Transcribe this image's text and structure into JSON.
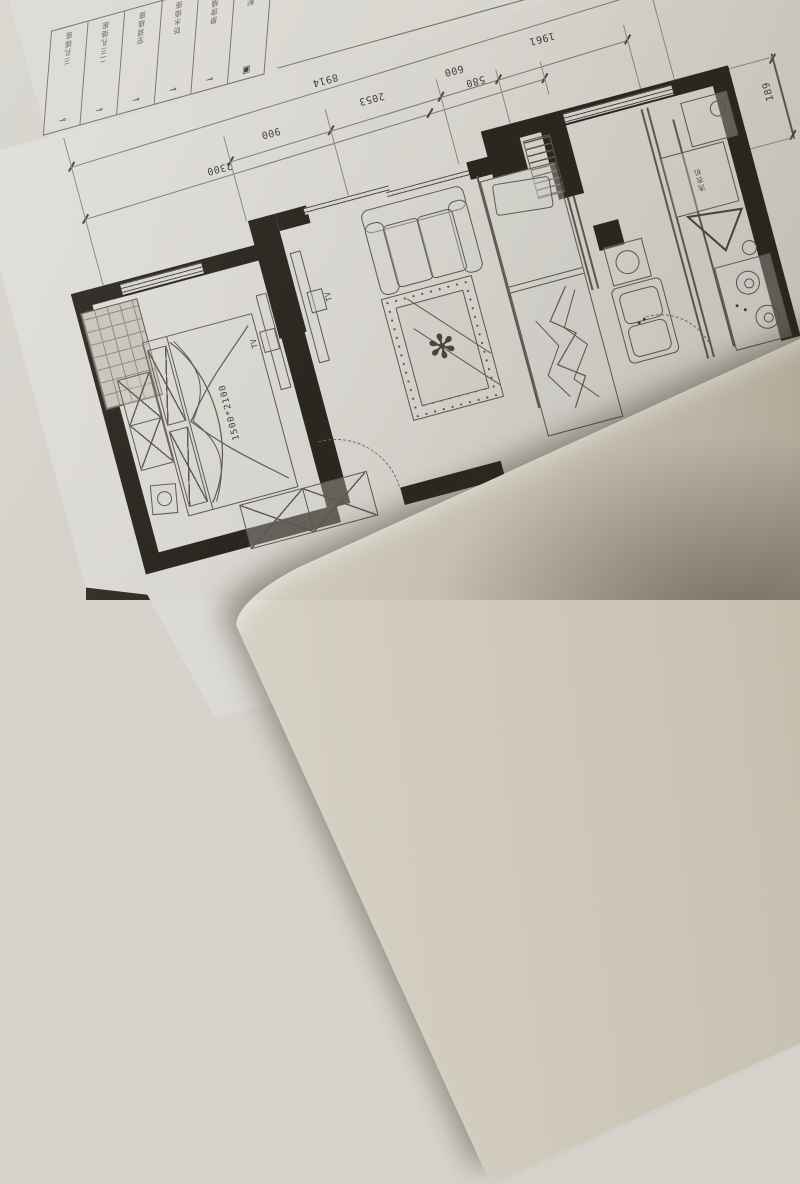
{
  "scene": {
    "description": "Photograph of a printed apartment floor plan on a table, rotated about 15 degrees, with a second blank sheet of paper overlapping the bottom-right corner"
  },
  "colors": {
    "paper": "#d8d6d0",
    "ink": "#5a5750",
    "wall_fill": "#26231d",
    "overlay_sheet": "#c8c2b2",
    "table": "#2e2a23"
  },
  "legend": {
    "items": [
      {
        "label": "三孔插座",
        "symbol": "⊸"
      },
      {
        "label": "二三孔插座",
        "symbol": "⊸"
      },
      {
        "label": "空调插座",
        "symbol": "⊸"
      },
      {
        "label": "防水插座",
        "symbol": "⊸"
      },
      {
        "label": "厨房插座",
        "symbol": "⊸"
      },
      {
        "label": "配电箱",
        "symbol": "▣"
      }
    ]
  },
  "dimensions": {
    "overall_top": "8914",
    "chain_mid": [
      "900",
      "2053",
      "600",
      "1961"
    ],
    "chain_inner": [
      "2300",
      "580"
    ],
    "right_side": "189"
  },
  "furniture": {
    "bed_label": "1500*2100",
    "tv_label": "TV",
    "washer_label": "洗衣机"
  }
}
